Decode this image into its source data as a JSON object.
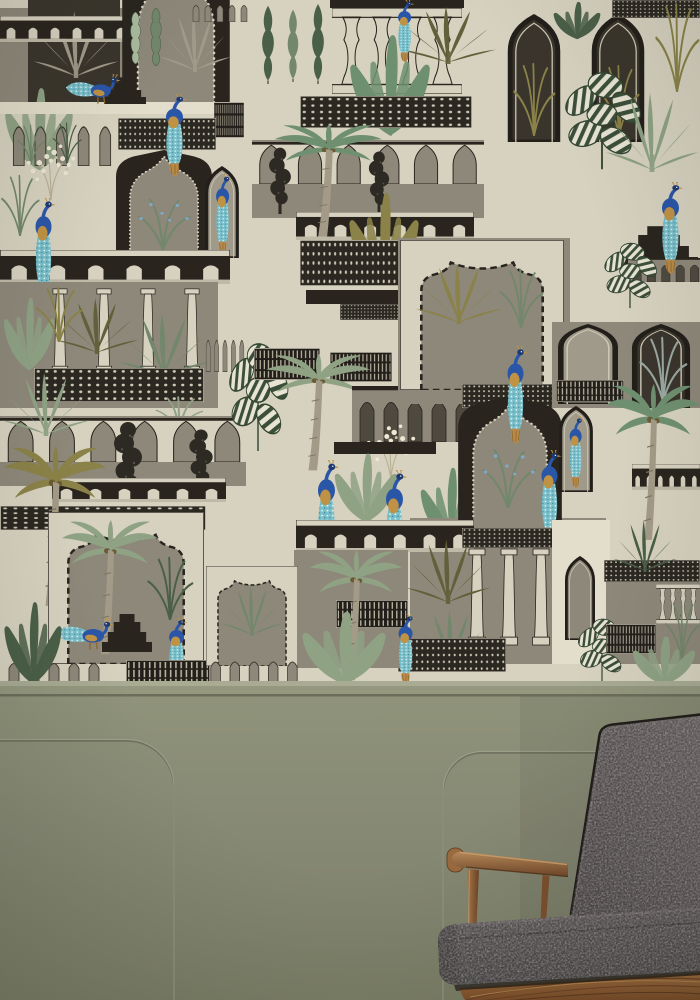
{
  "scene": {
    "description": "Peacock garden mural wallpaper with Mughal arches and palms above a sage green wainscot panel wall, charcoal grey mid-century armchair with walnut frame in the lower right corner",
    "palette": {
      "cream": "#d7d2c0",
      "cream2": "#e3decb",
      "taupe": "#8d887a",
      "taupe2": "#a09a8a",
      "ink": "#29241e",
      "ink2": "#3a352c",
      "sage": "#8fa284",
      "sage2": "#72876c",
      "deep": "#4a5f48",
      "pale": "#a9bb9e",
      "green": "#6f9070",
      "olive": "#8a8248",
      "olive2": "#62603a",
      "bluegray": "#9aa8a2",
      "blue": "#2a56a8",
      "navy": "#1d3a72",
      "teal": "#79bfca",
      "teal2": "#3e8fa0",
      "speck": "#eaf4f2",
      "gold": "#c09244",
      "gold2": "#8f6a2a",
      "trunk": "#a39b87",
      "wainscot": "#868974",
      "wainscot_light": "#989b82",
      "wainscot_dark": "#6b6e5a",
      "fabric": "#4e4849",
      "fabric_light": "#625b5c",
      "piping": "#1f1c1a",
      "wood": "#8a5a33",
      "wood_light": "#b4895a",
      "wood_dark": "#5d3a20"
    },
    "wallpaper": {
      "area": {
        "x": 0,
        "y": 0,
        "w": 700,
        "h": 687
      },
      "motifs": [
        [
          "rect",
          0,
          8,
          130,
          104,
          "taupe"
        ],
        [
          "rect",
          28,
          0,
          92,
          112,
          "ink2"
        ],
        [
          "palm-fan",
          32,
          4,
          88,
          74,
          "taupe2"
        ],
        [
          "balustrade",
          0,
          16,
          132,
          26
        ],
        [
          "cusped-arch",
          120,
          -42,
          112,
          152
        ],
        [
          "cactus",
          128,
          12,
          15,
          52,
          "pale"
        ],
        [
          "cactus",
          148,
          8,
          16,
          58,
          "sage2"
        ],
        [
          "palm-fan",
          158,
          6,
          74,
          66,
          "taupe2"
        ],
        [
          "banana",
          0,
          84,
          78,
          88,
          "sage"
        ],
        [
          "rect",
          0,
          102,
          232,
          12,
          "cream2"
        ],
        [
          "steps",
          104,
          76,
          42,
          28
        ],
        [
          "peacock-stand",
          64,
          74,
          62,
          32,
          null,
          1
        ],
        [
          "arcade-cream",
          190,
          0,
          60,
          22
        ],
        [
          "cypress",
          258,
          4,
          20,
          80,
          "deep"
        ],
        [
          "cypress",
          284,
          8,
          18,
          74,
          "sage2"
        ],
        [
          "cypress",
          308,
          2,
          20,
          82,
          "deep"
        ],
        [
          "rect",
          330,
          0,
          134,
          8,
          "ink"
        ],
        [
          "balusters",
          332,
          8,
          130,
          86
        ],
        [
          "banana",
          344,
          30,
          92,
          108,
          "green"
        ],
        [
          "lattice",
          300,
          96,
          172,
          32
        ],
        [
          "palm-fan",
          398,
          0,
          100,
          64,
          "olive2"
        ],
        [
          "peacock-hang",
          392,
          0,
          26,
          62
        ],
        [
          "window-lancet",
          506,
          14,
          56,
          128,
          "ink2"
        ],
        [
          "grass",
          512,
          62,
          44,
          74,
          "olive"
        ],
        [
          "window-lancet",
          590,
          14,
          56,
          128,
          "ink2"
        ],
        [
          "grass",
          598,
          64,
          42,
          72,
          "olive"
        ],
        [
          "banana",
          550,
          0,
          54,
          40,
          "deep"
        ],
        [
          "lattice",
          612,
          0,
          88,
          18
        ],
        [
          "grass",
          654,
          2,
          46,
          90,
          "olive"
        ],
        [
          "striped",
          556,
          62,
          92,
          110
        ],
        [
          "palm-fan",
          604,
          84,
          96,
          88,
          "sage"
        ],
        [
          "grille",
          214,
          102,
          30,
          36
        ],
        [
          "arcade-cream",
          8,
          114,
          108,
          52
        ],
        [
          "grass",
          16,
          124,
          30,
          40,
          "sage2"
        ],
        [
          "grass",
          52,
          122,
          30,
          42,
          "deep"
        ],
        [
          "flowers",
          14,
          140,
          74,
          62
        ],
        [
          "lattice",
          118,
          118,
          98,
          32
        ],
        [
          "cusped-arch",
          114,
          150,
          100,
          102
        ],
        [
          "reeds",
          128,
          194,
          70,
          56,
          "sage2"
        ],
        [
          "peacock-hang",
          158,
          94,
          34,
          82
        ],
        [
          "window-lancet",
          204,
          166,
          36,
          92,
          "taupe2"
        ],
        [
          "peacock-hang",
          210,
          174,
          26,
          80
        ],
        [
          "balustrade",
          0,
          250,
          230,
          34
        ],
        [
          "peacock-hang",
          28,
          198,
          32,
          102
        ],
        [
          "rect",
          0,
          282,
          218,
          126,
          "taupe"
        ],
        [
          "column",
          52,
          288,
          16,
          86
        ],
        [
          "column",
          96,
          288,
          16,
          86
        ],
        [
          "column",
          140,
          288,
          16,
          86
        ],
        [
          "column",
          184,
          288,
          16,
          86
        ],
        [
          "banana",
          0,
          294,
          58,
          78,
          "sage"
        ],
        [
          "palm-fan",
          54,
          292,
          86,
          62,
          "olive2"
        ],
        [
          "palm-fan",
          116,
          306,
          96,
          72,
          "sage2"
        ],
        [
          "grass",
          34,
          286,
          50,
          56,
          "olive"
        ],
        [
          "arcade-cream",
          204,
          330,
          42,
          42
        ],
        [
          "lattice",
          34,
          368,
          170,
          34
        ],
        [
          "grass",
          154,
          396,
          50,
          36,
          "sage"
        ],
        [
          "rect",
          0,
          416,
          246,
          70,
          "taupe"
        ],
        [
          "ogee-gallery",
          0,
          418,
          124,
          44
        ],
        [
          "ogee-gallery",
          124,
          418,
          124,
          44
        ],
        [
          "topiary",
          110,
          420,
          36,
          82
        ],
        [
          "topiary",
          186,
          428,
          30,
          64
        ],
        [
          "palm-fan",
          0,
          366,
          92,
          70,
          "sage"
        ],
        [
          "balustrade",
          52,
          478,
          174,
          24
        ],
        [
          "lattice",
          0,
          506,
          206,
          24
        ],
        [
          "palm-coco",
          0,
          446,
          106,
          162,
          "olive"
        ],
        [
          "mihrab",
          48,
          512,
          156,
          152
        ],
        [
          "palm-coco",
          58,
          520,
          100,
          136,
          "sage"
        ],
        [
          "grass",
          146,
          556,
          48,
          64,
          "deep"
        ],
        [
          "steps",
          102,
          612,
          50,
          40
        ],
        [
          "peacock-stand",
          54,
          618,
          66,
          34,
          null,
          1
        ],
        [
          "peacock-hang",
          162,
          618,
          30,
          68
        ],
        [
          "arcade-cream",
          4,
          656,
          100,
          30
        ],
        [
          "grille",
          126,
          660,
          84,
          26
        ],
        [
          "banana",
          0,
          598,
          66,
          88,
          "deep"
        ],
        [
          "rect",
          252,
          140,
          232,
          78,
          "taupe"
        ],
        [
          "ogee-gallery",
          252,
          142,
          116,
          42
        ],
        [
          "ogee-gallery",
          368,
          142,
          116,
          42
        ],
        [
          "topiary",
          266,
          146,
          28,
          68
        ],
        [
          "topiary",
          366,
          150,
          26,
          64
        ],
        [
          "balustrade",
          296,
          212,
          178,
          28
        ],
        [
          "palm-coco",
          270,
          124,
          112,
          114,
          "green"
        ],
        [
          "banana",
          344,
          188,
          80,
          100,
          "olive"
        ],
        [
          "lattice",
          300,
          240,
          108,
          46
        ],
        [
          "rect",
          306,
          290,
          98,
          14,
          "ink"
        ],
        [
          "lattice",
          340,
          304,
          66,
          16
        ],
        [
          "peacock-stand",
          426,
          348,
          54,
          28,
          null,
          1
        ],
        [
          "striped",
          222,
          332,
          72,
          122
        ],
        [
          "grille",
          254,
          348,
          66,
          32
        ],
        [
          "grille",
          330,
          352,
          62,
          30
        ],
        [
          "palm-coco",
          262,
          354,
          108,
          118,
          "sage"
        ],
        [
          "arcade",
          352,
          386,
          120,
          56
        ],
        [
          "flowers",
          354,
          420,
          74,
          62
        ],
        [
          "rect",
          334,
          442,
          102,
          12,
          "ink"
        ],
        [
          "banana",
          330,
          450,
          72,
          74,
          "sage"
        ],
        [
          "banana",
          416,
          464,
          70,
          80,
          "green"
        ],
        [
          "peacock-hang",
          310,
          460,
          34,
          108
        ],
        [
          "peacock-hang",
          378,
          470,
          34,
          104
        ],
        [
          "rect",
          410,
          518,
          196,
          146,
          "taupe"
        ],
        [
          "balustrade",
          296,
          520,
          178,
          32
        ],
        [
          "rect",
          398,
          238,
          172,
          166,
          "taupe"
        ],
        [
          "mihrab",
          400,
          240,
          164,
          150
        ],
        [
          "palm-fan",
          414,
          256,
          90,
          68,
          "olive"
        ],
        [
          "grass",
          498,
          268,
          46,
          60,
          "sage2"
        ],
        [
          "lattice",
          462,
          384,
          98,
          24
        ],
        [
          "cusped-arch",
          456,
          396,
          108,
          124
        ],
        [
          "reeds",
          472,
          444,
          72,
          64,
          "sage2"
        ],
        [
          "peacock-hang",
          500,
          346,
          32,
          98
        ],
        [
          "rect",
          552,
          322,
          148,
          86,
          "taupe"
        ],
        [
          "window-lancet",
          558,
          406,
          36,
          86,
          "taupe2"
        ],
        [
          "peacock-hang",
          564,
          416,
          24,
          72
        ],
        [
          "peacock-hang",
          534,
          450,
          32,
          92
        ],
        [
          "window-lancet",
          556,
          324,
          64,
          80,
          "taupe2"
        ],
        [
          "grille",
          556,
          380,
          68,
          22
        ],
        [
          "window-lancet",
          630,
          324,
          62,
          84,
          "ink2"
        ],
        [
          "grass",
          638,
          336,
          50,
          66,
          "bluegray"
        ],
        [
          "steps",
          620,
          224,
          78,
          44
        ],
        [
          "arcade",
          628,
          258,
          72,
          24
        ],
        [
          "peacock-hang",
          654,
          182,
          34,
          92
        ],
        [
          "striped",
          598,
          236,
          64,
          74
        ],
        [
          "balustrade",
          632,
          464,
          68,
          26
        ],
        [
          "palm-coco",
          602,
          384,
          98,
          158,
          "green"
        ],
        [
          "lattice",
          462,
          528,
          100,
          20
        ],
        [
          "column",
          468,
          548,
          18,
          98
        ],
        [
          "column",
          500,
          548,
          18,
          98
        ],
        [
          "column",
          532,
          548,
          18,
          98
        ],
        [
          "palm-fan",
          404,
          532,
          88,
          72,
          "olive2"
        ],
        [
          "palm-fan",
          412,
          604,
          78,
          60,
          "sage2"
        ],
        [
          "lattice",
          398,
          638,
          108,
          34
        ],
        [
          "rect",
          552,
          520,
          58,
          144,
          "cream2"
        ],
        [
          "window-lancet",
          564,
          556,
          32,
          84,
          "taupe"
        ],
        [
          "rect",
          606,
          580,
          94,
          84,
          "taupe"
        ],
        [
          "lattice",
          604,
          560,
          96,
          22
        ],
        [
          "balusters",
          656,
          584,
          44,
          40
        ],
        [
          "palm-fan",
          612,
          514,
          66,
          58,
          "deep"
        ],
        [
          "striped",
          572,
          612,
          60,
          72
        ],
        [
          "grille",
          606,
          624,
          50,
          30
        ],
        [
          "grass",
          664,
          600,
          36,
          60,
          "sage2"
        ],
        [
          "banana",
          628,
          634,
          72,
          52,
          "sage"
        ],
        [
          "rect",
          294,
          550,
          114,
          118,
          "taupe"
        ],
        [
          "grille",
          336,
          600,
          72,
          28
        ],
        [
          "palm-coco",
          306,
          550,
          96,
          132,
          "sage"
        ],
        [
          "mihrab",
          206,
          566,
          92,
          100
        ],
        [
          "palm-fan",
          220,
          580,
          64,
          56,
          "sage2"
        ],
        [
          "arcade-cream",
          206,
          654,
          96,
          32
        ],
        [
          "banana",
          296,
          608,
          96,
          78,
          "sage"
        ],
        [
          "peacock-hang",
          392,
          614,
          28,
          70
        ],
        [
          "grass",
          0,
          174,
          40,
          62,
          "sage2"
        ]
      ]
    },
    "wainscot": {
      "top": 681,
      "cap_bands": [
        [
          "#a9ac93",
          681,
          5
        ],
        [
          "#95987f",
          686,
          8
        ],
        [
          "#6b6e5a",
          694,
          2.5
        ]
      ],
      "grooves": [
        {
          "d": "M-6,740 H127 A47,47 0 0 1 174,787 V1006"
        },
        {
          "d": "M706,752 H482 A39,39 0 0 0 443,791 V1006"
        }
      ]
    },
    "chair": {
      "type": "mid-century armchair",
      "upholstery": "charcoal grey fabric",
      "frame": "walnut wood armrest, spindles and seat rail"
    }
  }
}
